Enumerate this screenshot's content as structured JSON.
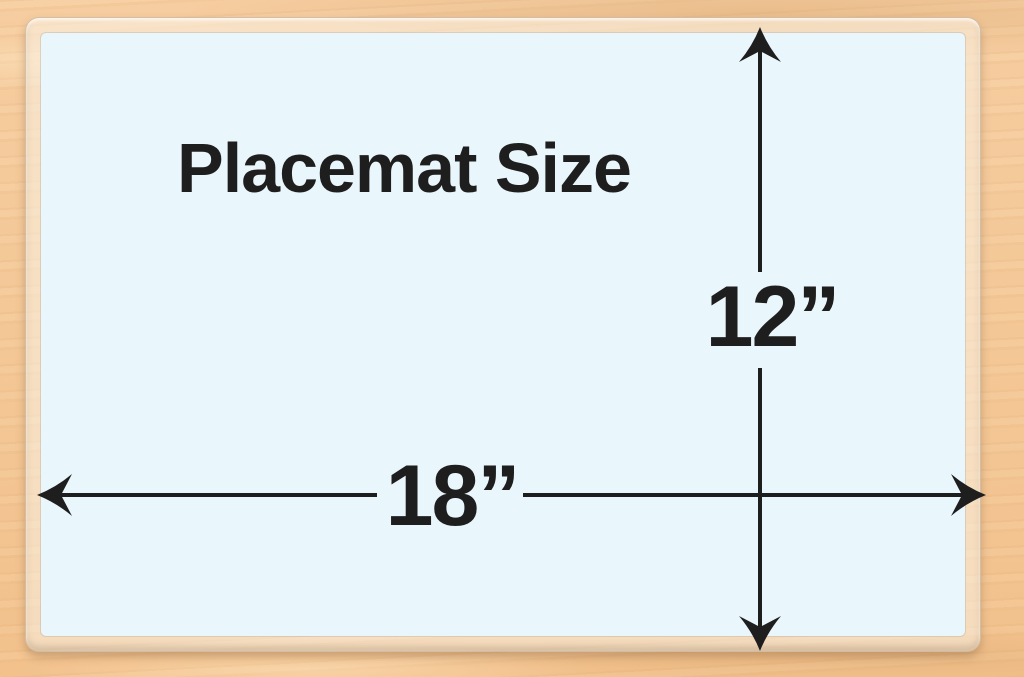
{
  "title": "Placemat Size",
  "dimensions": {
    "width_label": "18”",
    "height_label": "12”"
  },
  "icons": {
    "arrow_up": "barbed-arrowhead-up",
    "arrow_down": "barbed-arrowhead-down",
    "arrow_left": "barbed-arrowhead-left",
    "arrow_right": "barbed-arrowhead-right"
  },
  "colors": {
    "ink": "#1e1e1e",
    "placemat_surface": "#e9f6fb",
    "wood_base": "#f4c897"
  }
}
